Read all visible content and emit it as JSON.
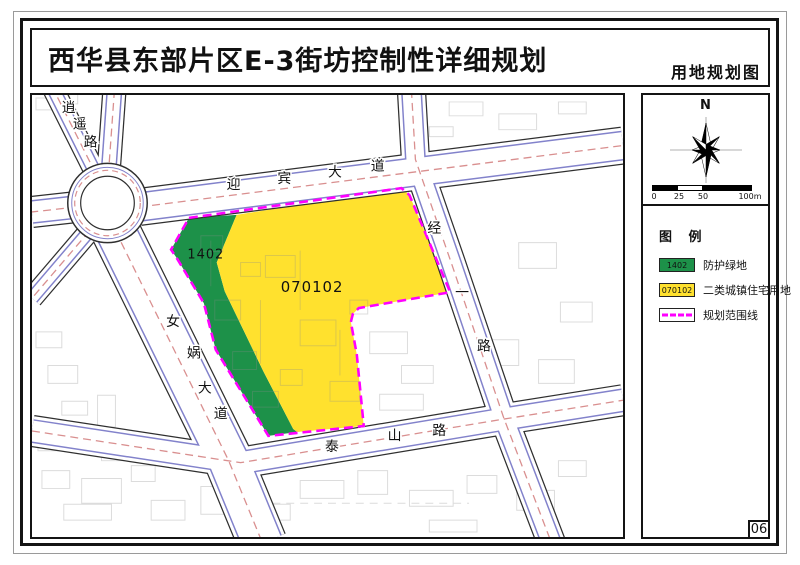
{
  "page": {
    "title": "西华县东部片区E-3街坊控制性详细规划",
    "map_type_label": "用地规划图",
    "page_number": "06"
  },
  "north_panel": {
    "north_label": "N",
    "scale_labels": [
      "0",
      "25",
      "50",
      "100m"
    ]
  },
  "legend": {
    "title": "图 例",
    "items": [
      {
        "code": "1402",
        "label": "防护绿地",
        "swatch": "green"
      },
      {
        "code": "070102",
        "label": "二类城镇住宅用地",
        "swatch": "yellow"
      },
      {
        "code": "",
        "label": "规划范围线",
        "swatch": "boundary"
      }
    ]
  },
  "map": {
    "parcel_labels": [
      {
        "code": "1402",
        "x": 205,
        "y": 258,
        "size": 13
      },
      {
        "code": "070102",
        "x": 312,
        "y": 292,
        "size": 15
      }
    ],
    "road_labels": [
      {
        "name": "逍遥路",
        "chars": [
          {
            "c": "逍",
            "x": 67,
            "y": 110
          },
          {
            "c": "遥",
            "x": 78,
            "y": 127
          },
          {
            "c": "路",
            "x": 89,
            "y": 145
          }
        ]
      },
      {
        "name": "迎宾大道",
        "chars": [
          {
            "c": "迎",
            "x": 233,
            "y": 188
          },
          {
            "c": "宾",
            "x": 284,
            "y": 182
          },
          {
            "c": "大",
            "x": 335,
            "y": 175
          },
          {
            "c": "道",
            "x": 378,
            "y": 169
          }
        ]
      },
      {
        "name": "经一路",
        "chars": [
          {
            "c": "经",
            "x": 435,
            "y": 232
          },
          {
            "c": "一",
            "x": 463,
            "y": 297
          },
          {
            "c": "路",
            "x": 485,
            "y": 351
          }
        ]
      },
      {
        "name": "女娲大道",
        "chars": [
          {
            "c": "女",
            "x": 172,
            "y": 326
          },
          {
            "c": "娲",
            "x": 193,
            "y": 358
          },
          {
            "c": "大",
            "x": 204,
            "y": 393
          },
          {
            "c": "道",
            "x": 220,
            "y": 419
          }
        ]
      },
      {
        "name": "泰山路",
        "chars": [
          {
            "c": "泰",
            "x": 332,
            "y": 452
          },
          {
            "c": "山",
            "x": 395,
            "y": 441
          },
          {
            "c": "路",
            "x": 440,
            "y": 436
          }
        ]
      }
    ]
  },
  "colors": {
    "protective_green": "#1d9149",
    "residential_yellow": "#ffe12e",
    "boundary_magenta": "#ff00ff",
    "road_centerline_red": "#d98f8f",
    "road_curb_blue": "#8282cb",
    "road_casing_black": "#2f2f2f"
  }
}
